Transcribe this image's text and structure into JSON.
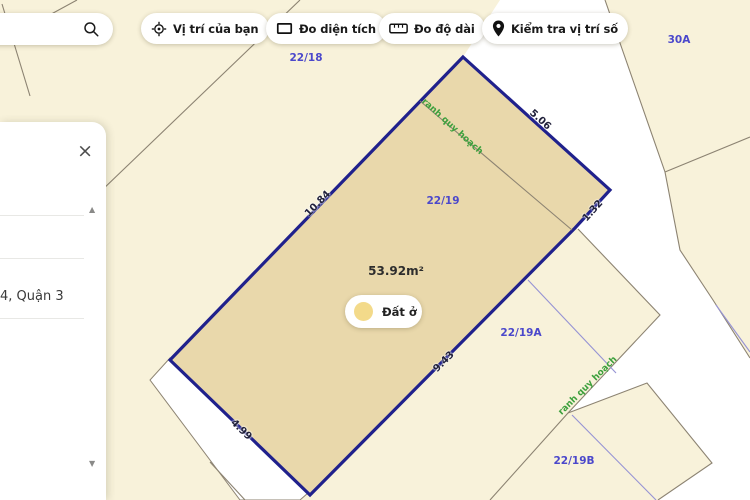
{
  "toolbar": {
    "search": {
      "value": "",
      "placeholder": ""
    },
    "buttons": [
      {
        "label": "Vị trí của bạn",
        "icon": "crosshair-icon"
      },
      {
        "label": "Đo diện tích",
        "icon": "area-rectangle-icon"
      },
      {
        "label": "Đo độ dài",
        "icon": "ruler-icon"
      },
      {
        "label": "Kiểm tra vị trí số",
        "icon": "map-pin-icon"
      }
    ]
  },
  "panel": {
    "visible_item_text": "4, Quận 3"
  },
  "map": {
    "highlighted_parcel": {
      "id_label": "22/19",
      "area_label": "53.92m²",
      "land_use_chip": "Đất ở",
      "edge_lengths": [
        "10.84",
        "5.06",
        "1.32",
        "9.43",
        "4.99"
      ]
    },
    "parcel_labels": [
      "22/18",
      "30A",
      "22/19A",
      "22/19B"
    ],
    "planning_boundary_label": "ranh quy hoạch",
    "colors": {
      "background": "#f8f2da",
      "road": "#ffffff",
      "highlight_fill": "#e9d8ab",
      "highlight_border": "#20218c",
      "parcel_line": "#8c8372",
      "planning_line": "#9693d4",
      "label_purple": "#4b48cb",
      "label_green": "#3da03d"
    }
  }
}
